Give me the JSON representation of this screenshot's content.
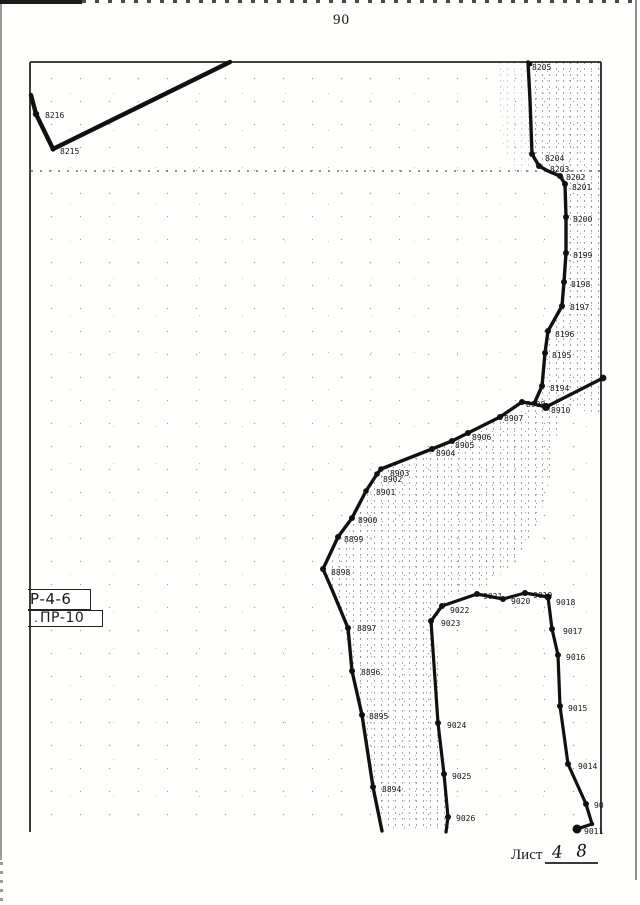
{
  "page": {
    "number": "90",
    "sheet_caption": "Лист",
    "sheet_number": "4 8"
  },
  "legend": {
    "box1_label": "Р-4-6",
    "box2_label": "ПР-10",
    "box2_prefix": "."
  },
  "colors": {
    "ink": "#111111",
    "frame": "#262626",
    "scan_gray": "#9a9a9a"
  },
  "map": {
    "frame_segments": [
      [
        30,
        62,
        601,
        62
      ],
      [
        30,
        62,
        30,
        832
      ],
      [
        601,
        62,
        601,
        834
      ]
    ],
    "polylines": [
      {
        "name": "boundary-line-8216-8215",
        "w": 4.4,
        "pts": [
          [
            31,
            95
          ],
          [
            36,
            114
          ],
          [
            53,
            149
          ],
          [
            230,
            62
          ]
        ]
      },
      {
        "name": "boundary-line-8205-8194",
        "w": 3.4,
        "pts": [
          [
            528,
            62
          ],
          [
            530,
            100
          ],
          [
            532,
            154
          ],
          [
            539,
            166
          ],
          [
            548,
            171
          ],
          [
            560,
            176
          ],
          [
            565,
            184
          ],
          [
            566,
            217
          ],
          [
            566,
            253
          ],
          [
            564,
            282
          ],
          [
            562,
            306
          ],
          [
            548,
            331
          ],
          [
            545,
            353
          ],
          [
            542,
            386
          ],
          [
            534,
            404
          ]
        ]
      },
      {
        "name": "boundary-line-8898-8910-border",
        "w": 3.4,
        "pts": [
          [
            323,
            569
          ],
          [
            338,
            537
          ],
          [
            352,
            518
          ],
          [
            366,
            491
          ],
          [
            377,
            474
          ],
          [
            381,
            469
          ],
          [
            432,
            449
          ],
          [
            452,
            441
          ],
          [
            468,
            433
          ],
          [
            500,
            417
          ],
          [
            522,
            402
          ],
          [
            534,
            404
          ],
          [
            546,
            407
          ],
          [
            603,
            378
          ]
        ]
      },
      {
        "name": "boundary-line-8898-8894",
        "w": 3.4,
        "pts": [
          [
            323,
            569
          ],
          [
            333,
            592
          ],
          [
            348,
            628
          ],
          [
            352,
            671
          ],
          [
            362,
            715
          ],
          [
            373,
            787
          ],
          [
            382,
            831
          ]
        ]
      },
      {
        "name": "boundary-line-9026-9011",
        "w": 3.2,
        "pts": [
          [
            446,
            832
          ],
          [
            448,
            817
          ],
          [
            444,
            774
          ],
          [
            438,
            723
          ],
          [
            431,
            621
          ],
          [
            442,
            606
          ],
          [
            477,
            594
          ],
          [
            503,
            599
          ],
          [
            525,
            593
          ],
          [
            548,
            597
          ],
          [
            552,
            629
          ],
          [
            558,
            655
          ],
          [
            560,
            706
          ],
          [
            568,
            764
          ],
          [
            586,
            804
          ],
          [
            592,
            824
          ],
          [
            577,
            829
          ]
        ]
      }
    ],
    "points": [
      {
        "label": "8216",
        "x": 36,
        "y": 114,
        "r": 3.2,
        "tx": 45,
        "ty": 118
      },
      {
        "label": "8215",
        "x": 53,
        "y": 149,
        "r": 2.6,
        "tx": 60,
        "ty": 154
      },
      {
        "label": "8205",
        "x": 530,
        "y": 64,
        "r": 2.4,
        "tx": 532,
        "ty": 70
      },
      {
        "label": "8204",
        "x": 532,
        "y": 154,
        "r": 3,
        "tx": 545,
        "ty": 161
      },
      {
        "label": "8203",
        "x": 539,
        "y": 166,
        "r": 3,
        "tx": 550,
        "ty": 172
      },
      {
        "label": "8202",
        "x": 560,
        "y": 176,
        "r": 3,
        "tx": 566,
        "ty": 180
      },
      {
        "label": "8201",
        "x": 565,
        "y": 184,
        "r": 3,
        "tx": 572,
        "ty": 190
      },
      {
        "label": "8200",
        "x": 566,
        "y": 217,
        "r": 3,
        "tx": 573,
        "ty": 222
      },
      {
        "label": "8199",
        "x": 566,
        "y": 253,
        "r": 3,
        "tx": 573,
        "ty": 258
      },
      {
        "label": "8198",
        "x": 564,
        "y": 282,
        "r": 3,
        "tx": 571,
        "ty": 287
      },
      {
        "label": "8197",
        "x": 562,
        "y": 306,
        "r": 3,
        "tx": 570,
        "ty": 310
      },
      {
        "label": "8196",
        "x": 548,
        "y": 331,
        "r": 3,
        "tx": 555,
        "ty": 337
      },
      {
        "label": "8195",
        "x": 545,
        "y": 353,
        "r": 3,
        "tx": 552,
        "ty": 358
      },
      {
        "label": "8194",
        "x": 542,
        "y": 386,
        "r": 3,
        "tx": 550,
        "ty": 391
      },
      {
        "label": "8910",
        "x": 546,
        "y": 407,
        "r": 4,
        "tx": 551,
        "ty": 413
      },
      {
        "label": "8908",
        "x": 522,
        "y": 402,
        "r": 3,
        "tx": 526,
        "ty": 407
      },
      {
        "label": "8907",
        "x": 500,
        "y": 417,
        "r": 3,
        "tx": 504,
        "ty": 421
      },
      {
        "label": "8906",
        "x": 468,
        "y": 433,
        "r": 3,
        "tx": 472,
        "ty": 440
      },
      {
        "label": "8905",
        "x": 452,
        "y": 441,
        "r": 3,
        "tx": 455,
        "ty": 448
      },
      {
        "label": "8904",
        "x": 432,
        "y": 449,
        "r": 3,
        "tx": 436,
        "ty": 456
      },
      {
        "label": "8903",
        "x": 381,
        "y": 469,
        "r": 2.8,
        "tx": 390,
        "ty": 476
      },
      {
        "label": "8902",
        "x": 377,
        "y": 474,
        "r": 2.8,
        "tx": 383,
        "ty": 482
      },
      {
        "label": "8901",
        "x": 366,
        "y": 491,
        "r": 2.8,
        "tx": 376,
        "ty": 495
      },
      {
        "label": "8900",
        "x": 352,
        "y": 518,
        "r": 3,
        "tx": 358,
        "ty": 523
      },
      {
        "label": "8899",
        "x": 338,
        "y": 537,
        "r": 3,
        "tx": 344,
        "ty": 542
      },
      {
        "label": "8898",
        "x": 323,
        "y": 569,
        "r": 3,
        "tx": 331,
        "ty": 575
      },
      {
        "label": "8897",
        "x": 348,
        "y": 628,
        "r": 3,
        "tx": 357,
        "ty": 631
      },
      {
        "label": "8896",
        "x": 352,
        "y": 671,
        "r": 3,
        "tx": 361,
        "ty": 675
      },
      {
        "label": "8895",
        "x": 362,
        "y": 715,
        "r": 3,
        "tx": 369,
        "ty": 719
      },
      {
        "label": "8894",
        "x": 373,
        "y": 787,
        "r": 3,
        "tx": 382,
        "ty": 792
      },
      {
        "label": "9022",
        "x": 442,
        "y": 606,
        "r": 3,
        "tx": 450,
        "ty": 613
      },
      {
        "label": "9023",
        "x": 431,
        "y": 621,
        "r": 3,
        "tx": 441,
        "ty": 626
      },
      {
        "label": "9021",
        "x": 477,
        "y": 594,
        "r": 3,
        "tx": 483,
        "ty": 599
      },
      {
        "label": "9020",
        "x": 503,
        "y": 599,
        "r": 3,
        "tx": 511,
        "ty": 604
      },
      {
        "label": "9019",
        "x": 525,
        "y": 593,
        "r": 3,
        "tx": 533,
        "ty": 598
      },
      {
        "label": "9018",
        "x": 548,
        "y": 597,
        "r": 3.4,
        "tx": 556,
        "ty": 605
      },
      {
        "label": "9017",
        "x": 552,
        "y": 629,
        "r": 3,
        "tx": 563,
        "ty": 634
      },
      {
        "label": "9016",
        "x": 558,
        "y": 655,
        "r": 3,
        "tx": 566,
        "ty": 660
      },
      {
        "label": "9015",
        "x": 560,
        "y": 706,
        "r": 3,
        "tx": 568,
        "ty": 711
      },
      {
        "label": "9014",
        "x": 568,
        "y": 764,
        "r": 3,
        "tx": 578,
        "ty": 769
      },
      {
        "label": "90",
        "x": 586,
        "y": 804,
        "r": 3,
        "tx": 594,
        "ty": 808
      },
      {
        "label": "9011",
        "x": 577,
        "y": 829,
        "r": 4.5,
        "tx": 584,
        "ty": 834
      },
      {
        "label": "9024",
        "x": 438,
        "y": 723,
        "r": 3,
        "tx": 447,
        "ty": 728
      },
      {
        "label": "9025",
        "x": 444,
        "y": 774,
        "r": 3,
        "tx": 452,
        "ty": 779
      },
      {
        "label": "9026",
        "x": 448,
        "y": 817,
        "r": 3,
        "tx": 456,
        "ty": 821
      },
      {
        "label": "",
        "x": 603,
        "y": 378,
        "r": 3.4
      },
      {
        "label": "",
        "x": 592,
        "y": 824,
        "r": 2.2
      }
    ]
  }
}
